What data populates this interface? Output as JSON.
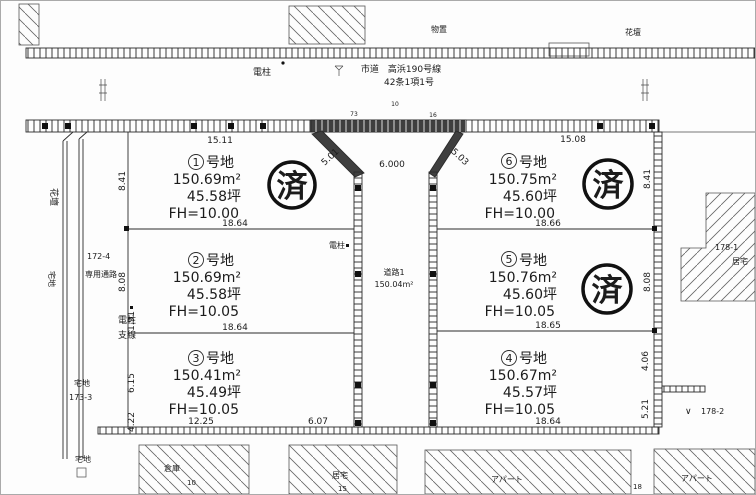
{
  "top": {
    "shed_label": "物置",
    "flowerbed_label": "花壇",
    "pole_label": "電柱",
    "road_name": "市道　高浜190号線",
    "road_designation": "42条1項1号",
    "marks": [
      "73",
      "10",
      "16"
    ]
  },
  "lots": [
    {
      "num": "1",
      "suffix": "号地",
      "area": "150.69m²",
      "tsubo": "45.58坪",
      "fh": "FH=10.00",
      "stamp": "済"
    },
    {
      "num": "2",
      "suffix": "号地",
      "area": "150.69m²",
      "tsubo": "45.58坪",
      "fh": "FH=10.05",
      "stamp": ""
    },
    {
      "num": "3",
      "suffix": "号地",
      "area": "150.41m²",
      "tsubo": "45.49坪",
      "fh": "FH=10.05",
      "stamp": ""
    },
    {
      "num": "4",
      "suffix": "号地",
      "area": "150.67m²",
      "tsubo": "45.57坪",
      "fh": "FH=10.05",
      "stamp": ""
    },
    {
      "num": "5",
      "suffix": "号地",
      "area": "150.76m²",
      "tsubo": "45.60坪",
      "fh": "FH=10.05",
      "stamp": "済"
    },
    {
      "num": "6",
      "suffix": "号地",
      "area": "150.75m²",
      "tsubo": "45.60坪",
      "fh": "FH=10.00",
      "stamp": "済"
    }
  ],
  "road": {
    "label": "道路1",
    "area": "150.04m²",
    "pole": "電柱"
  },
  "dims": {
    "lot1_top": "15.11",
    "lot6_top": "15.08",
    "road_top_width": "6.000",
    "diag_left": "5.01",
    "diag_right": "5.03",
    "lot1_bottom": "18.64",
    "lot2_bottom": "18.64",
    "lot3_bottom_w": "12.25",
    "lot3_bottom_e": "6.07",
    "lot6_bottom": "18.66",
    "lot5_bottom": "18.65",
    "lot4_bottom": "18.64",
    "left_lot1": "8.41",
    "left_lot2": "8.08",
    "left_a": "1.91",
    "left_b": "6.15",
    "left_c": "4.22",
    "right_lot6": "8.41",
    "right_lot5": "8.08",
    "right_a": "4.06",
    "right_b": "5.21"
  },
  "west": {
    "flowerbed": "花壇",
    "takuchi": "宅地",
    "parcel": "172-4",
    "private_path": "専用通路",
    "pole_line1": "電柱",
    "pole_line2": "支線",
    "sw_takuchi": "宅地",
    "sw_parcel": "173-3",
    "s_takuchi": "宅地"
  },
  "east": {
    "parcel1": "178-1",
    "house": "居宅",
    "check": "∨",
    "parcel2": "178-2"
  },
  "south": {
    "warehouse": "倉庫",
    "warehouse_no": "10",
    "house": "居宅",
    "house_no": "15",
    "apartment_west": "アパート",
    "gap_no": "18",
    "apartment_east": "アパート"
  }
}
